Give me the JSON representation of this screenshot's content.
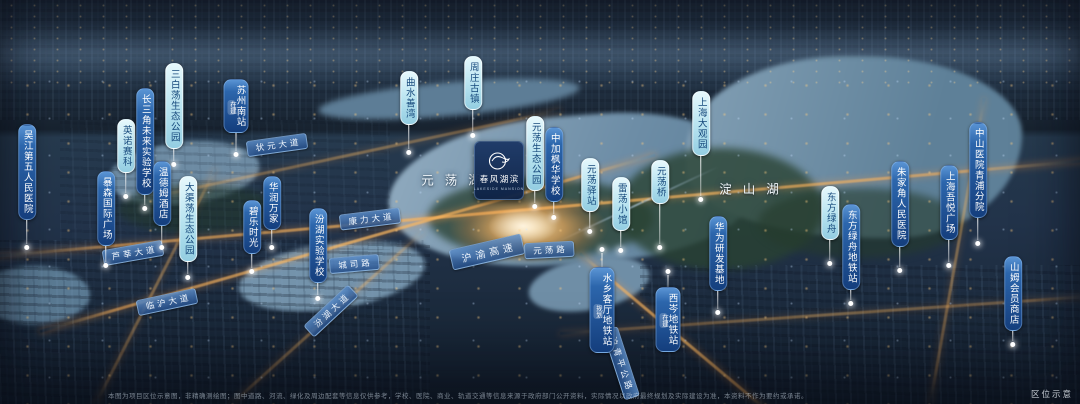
{
  "project": {
    "name": "春风湖滨",
    "name_en": "LAKESIDE MANSION"
  },
  "lakes": [
    {
      "name": "元荡湖",
      "x": 451,
      "y": 179
    },
    {
      "name": "淀山湖",
      "x": 749,
      "y": 188
    }
  ],
  "poi_labels": [
    {
      "text": "吴江第五人民医院",
      "style": "navy",
      "x": 27,
      "y": 124,
      "line": 24,
      "dir": "down"
    },
    {
      "text": "暴森国际广场",
      "style": "navy",
      "x": 106,
      "y": 171,
      "line": 16,
      "dir": "down"
    },
    {
      "text": "英诺赛科",
      "style": "cyan",
      "x": 126,
      "y": 119,
      "line": 20,
      "dir": "down"
    },
    {
      "text": "长三角未来实验学校",
      "style": "navy",
      "x": 145,
      "y": 88,
      "line": 10,
      "dir": "down"
    },
    {
      "text": "三白荡生态公园",
      "style": "cyan",
      "x": 174,
      "y": 63,
      "line": 12,
      "dir": "down"
    },
    {
      "text": "温德姆酒店",
      "style": "navy",
      "x": 162,
      "y": 161,
      "line": 18,
      "dir": "down"
    },
    {
      "text": "大渠荡生态公园",
      "style": "cyan",
      "x": 188,
      "y": 176,
      "line": 12,
      "dir": "down"
    },
    {
      "text": "苏州南站",
      "style": "navy",
      "x": 236,
      "y": 79,
      "tag": "在建",
      "line": 18,
      "dir": "down"
    },
    {
      "text": "华润万家",
      "style": "navy",
      "x": 272,
      "y": 176,
      "line": 14,
      "dir": "down"
    },
    {
      "text": "碧乐时光",
      "style": "navy",
      "x": 252,
      "y": 200,
      "line": 14,
      "dir": "down"
    },
    {
      "text": "汾湖实验学校",
      "style": "navy",
      "x": 318,
      "y": 208,
      "line": 12,
      "dir": "down"
    },
    {
      "text": "曲水善湾",
      "style": "cyan",
      "x": 409,
      "y": 71,
      "line": 24,
      "dir": "down"
    },
    {
      "text": "周庄古镇",
      "style": "cyan",
      "x": 473,
      "y": 56,
      "line": 22,
      "dir": "down"
    },
    {
      "text": "元荡生态公园",
      "style": "cyan",
      "x": 535,
      "y": 116,
      "line": 12,
      "dir": "down"
    },
    {
      "text": "中加枫华学校",
      "style": "navy",
      "x": 554,
      "y": 127,
      "line": 12,
      "dir": "down"
    },
    {
      "text": "元荡驿站",
      "style": "cyan",
      "x": 590,
      "y": 158,
      "line": 16,
      "dir": "down"
    },
    {
      "text": "雷荡小馆",
      "style": "cyan",
      "x": 621,
      "y": 177,
      "line": 16,
      "dir": "down"
    },
    {
      "text": "元荡桥",
      "style": "cyan",
      "x": 660,
      "y": 160,
      "line": 40,
      "dir": "down"
    },
    {
      "text": "上海大观园",
      "style": "cyan",
      "x": 701,
      "y": 91,
      "line": 40,
      "dir": "down"
    },
    {
      "text": "华为研发基地",
      "style": "navy",
      "x": 718,
      "y": 216,
      "line": 18,
      "dir": "down"
    },
    {
      "text": "水乡客厅地铁站",
      "style": "navy",
      "x": 602,
      "y": 246,
      "tag": "规划",
      "line": 14,
      "dir": "up"
    },
    {
      "text": "西岑地铁站",
      "style": "navy",
      "x": 668,
      "y": 268,
      "tag": "在建",
      "line": 12,
      "dir": "up"
    },
    {
      "text": "东方绿舟",
      "style": "cyan",
      "x": 830,
      "y": 186,
      "line": 20,
      "dir": "down"
    },
    {
      "text": "东方绿舟地铁站",
      "style": "navy",
      "x": 851,
      "y": 204,
      "line": 10,
      "dir": "down"
    },
    {
      "text": "朱家角人民医院",
      "style": "navy",
      "x": 900,
      "y": 161,
      "line": 20,
      "dir": "down"
    },
    {
      "text": "中山医院青浦分院",
      "style": "navy",
      "x": 978,
      "y": 122,
      "line": 22,
      "dir": "down"
    },
    {
      "text": "上海吾悦广场",
      "style": "navy",
      "x": 949,
      "y": 165,
      "line": 22,
      "dir": "down"
    },
    {
      "text": "山姆会员商店",
      "style": "navy",
      "x": 1013,
      "y": 256,
      "line": 10,
      "dir": "down"
    }
  ],
  "road_labels": [
    {
      "text": "状元大道",
      "x": 277,
      "y": 145,
      "rot": -8,
      "big": false
    },
    {
      "text": "康力大道",
      "x": 370,
      "y": 219,
      "rot": -7,
      "big": false
    },
    {
      "text": "城司路",
      "x": 354,
      "y": 264,
      "rot": -5,
      "big": false
    },
    {
      "text": "芦莘大道",
      "x": 133,
      "y": 253,
      "rot": -10,
      "big": false
    },
    {
      "text": "临沪大道",
      "x": 167,
      "y": 302,
      "rot": -12,
      "big": false
    },
    {
      "text": "汾湖大道",
      "x": 331,
      "y": 311,
      "rot": -43,
      "big": false
    },
    {
      "text": "沪渝高速",
      "x": 487,
      "y": 252,
      "rot": -13,
      "big": true
    },
    {
      "text": "元荡路",
      "x": 549,
      "y": 250,
      "rot": -3,
      "big": false
    },
    {
      "text": "沪青平公路",
      "x": 621,
      "y": 363,
      "rot": 72,
      "big": false
    }
  ],
  "footer": {
    "disclaimer": "本图为项目区位示意图，非精确测绘图；图中道路、河流、绿化及周边配套等信息仅供参考，学校、医院、商业、轨道交通等信息来源于政府部门公开资料，实际情况以政府最终规划及实际建设为准，本资料不作为要约或承诺。",
    "corner_label": "区位示意"
  },
  "colors": {
    "label_navy": "#143e7d",
    "label_cyan": "#b6e2ef",
    "road_ribbon": "#26508c",
    "road_glow": "#ffaf55",
    "water": "#84a0b6"
  }
}
